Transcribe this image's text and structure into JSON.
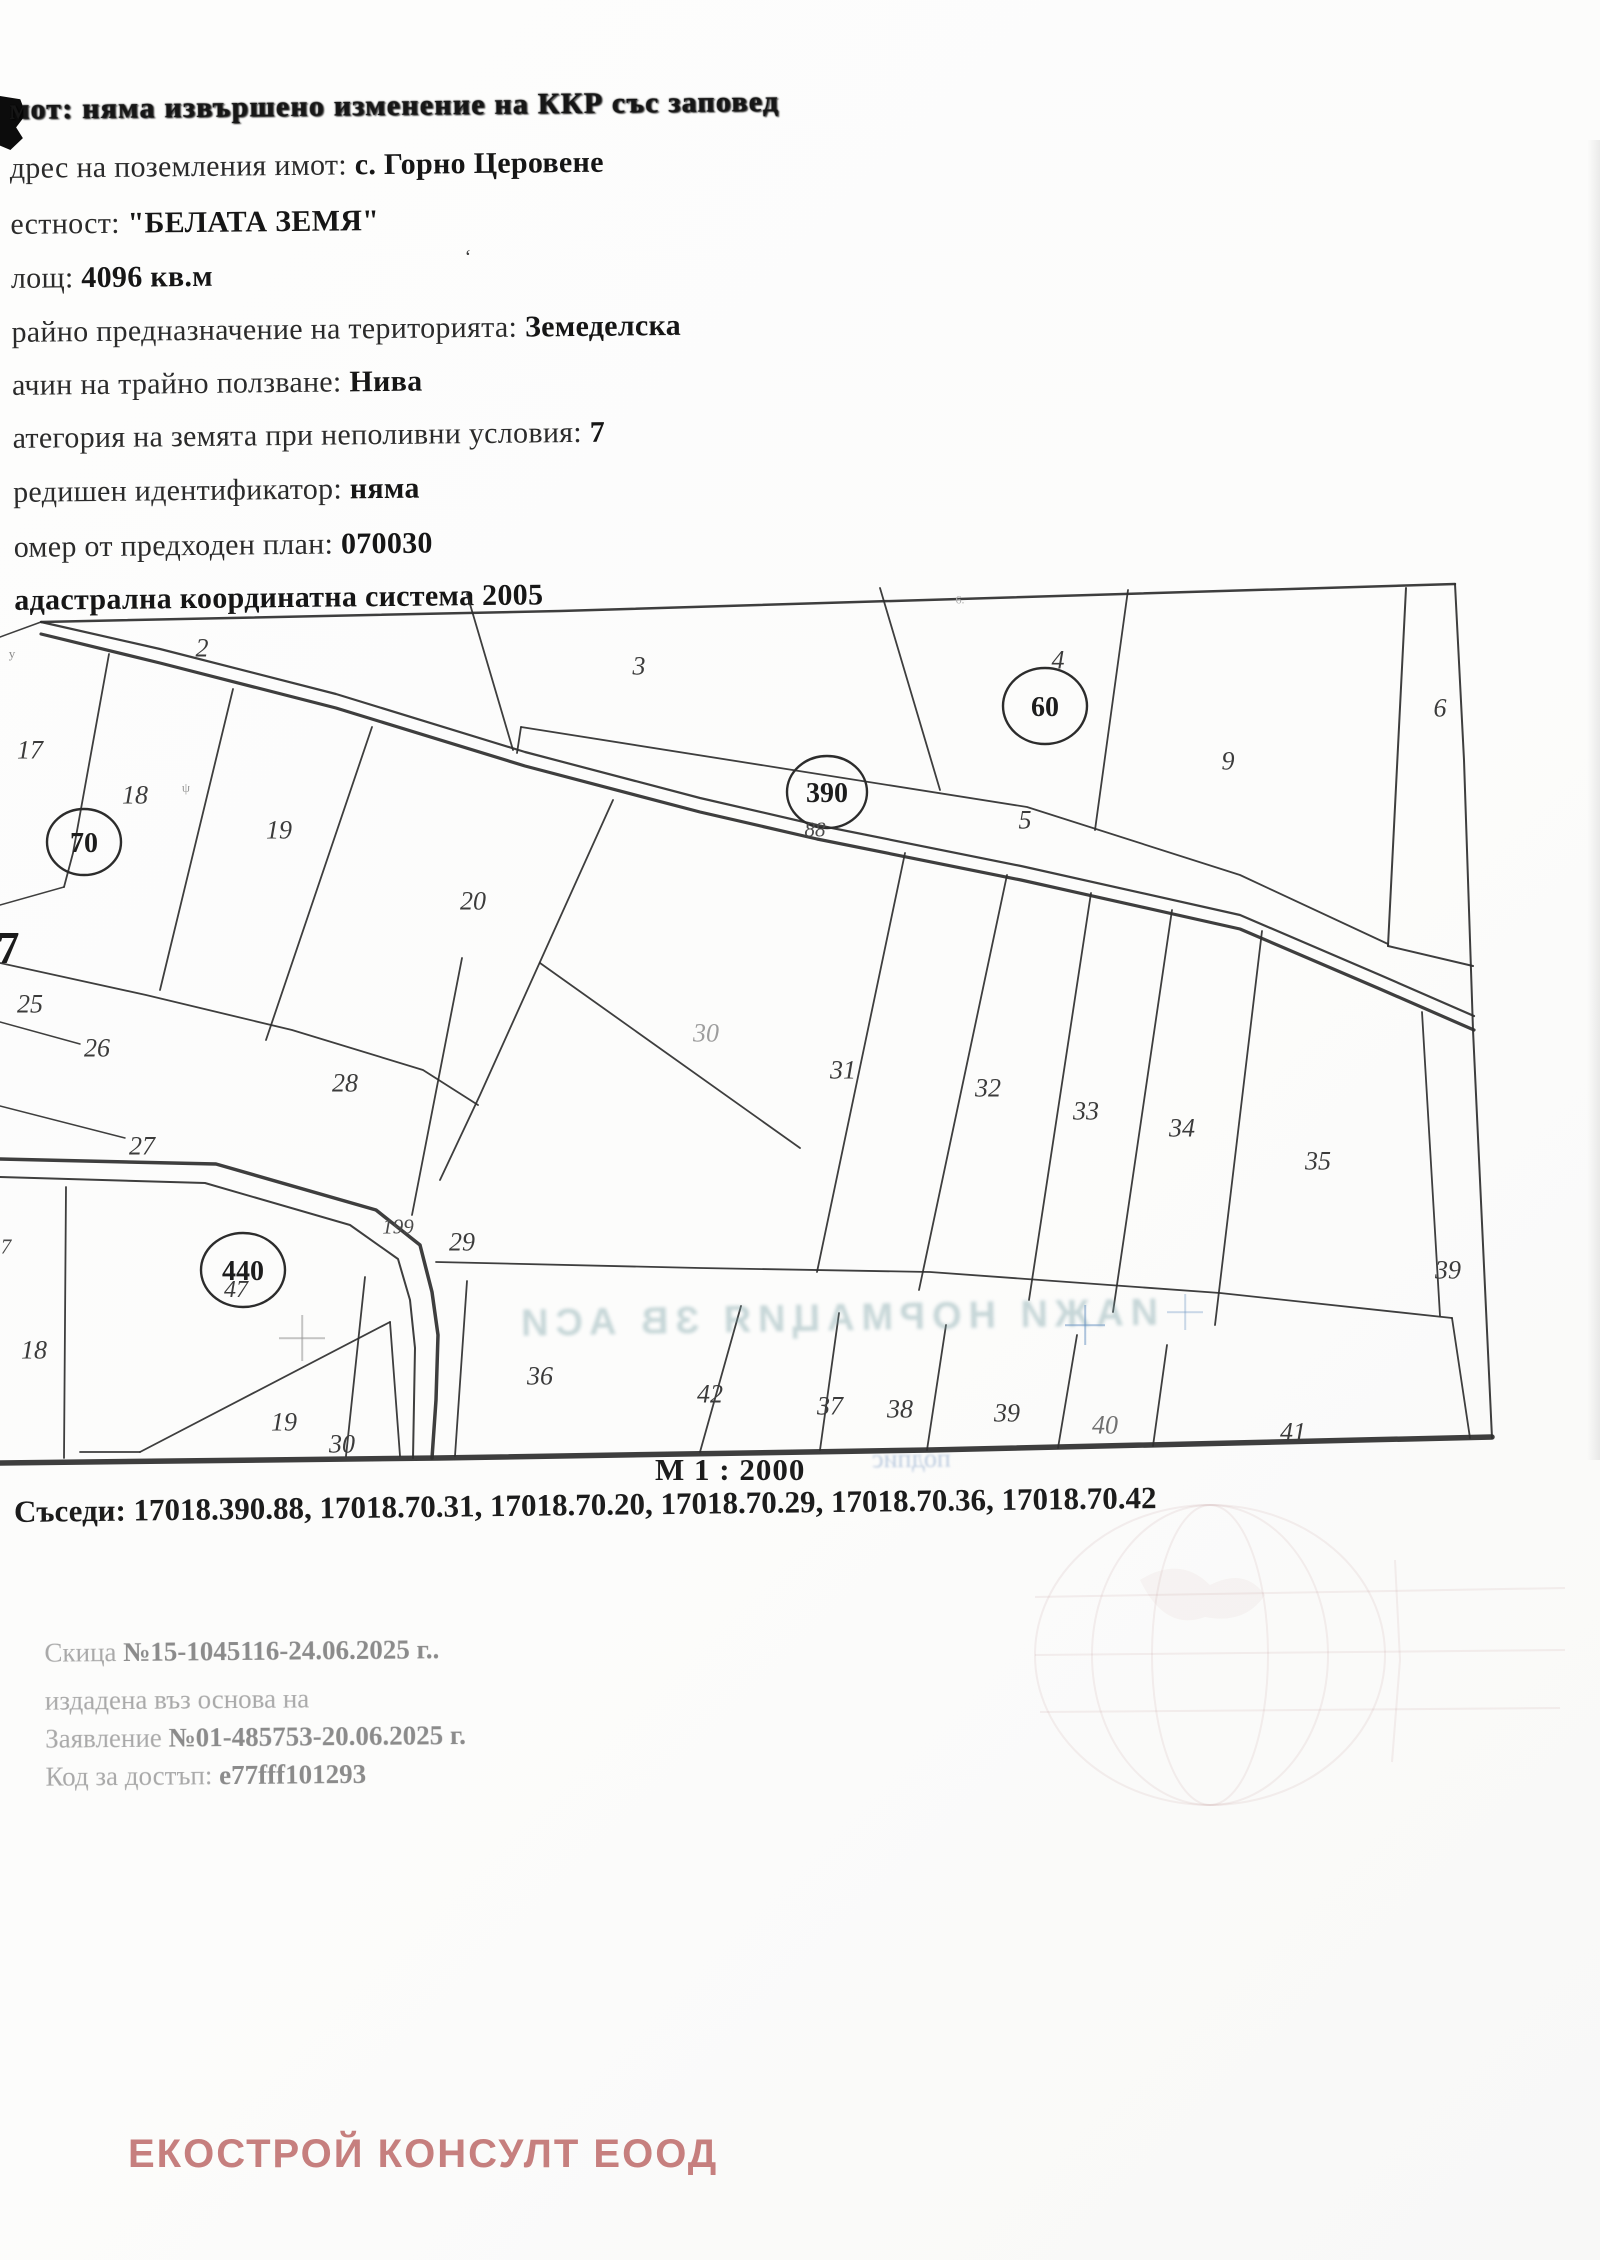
{
  "header": {
    "lines": [
      {
        "base": 123,
        "smeared": true,
        "parts": [
          {
            "t": "мот: ",
            "b": true
          },
          {
            "t": "няма извършено изменение на ККР със заповед",
            "b": true
          }
        ]
      },
      {
        "base": 182,
        "parts": [
          {
            "t": "дрес на поземления имот: "
          },
          {
            "t": "с. Горно Церовене",
            "b": true
          }
        ]
      },
      {
        "base": 238,
        "parts": [
          {
            "t": "естност: "
          },
          {
            "t": "\"БЕЛАТА ЗЕМЯ\"",
            "b": true
          }
        ]
      },
      {
        "base": 292,
        "parts": [
          {
            "t": "лощ: "
          },
          {
            "t": "4096 кв.м",
            "b": true
          }
        ]
      },
      {
        "base": 346,
        "parts": [
          {
            "t": "райно предназначение на територията: "
          },
          {
            "t": "Земеделска",
            "b": true
          }
        ]
      },
      {
        "base": 399,
        "parts": [
          {
            "t": "ачин на трайно ползване: "
          },
          {
            "t": "Нива",
            "b": true
          }
        ]
      },
      {
        "base": 452,
        "parts": [
          {
            "t": "атегория на земята при неполивни условия: "
          },
          {
            "t": "7",
            "b": true
          }
        ]
      },
      {
        "base": 506,
        "parts": [
          {
            "t": "редишен идентификатор: "
          },
          {
            "t": "няма",
            "b": true
          }
        ]
      },
      {
        "base": 561,
        "parts": [
          {
            "t": "омер от предходен план: "
          },
          {
            "t": "070030",
            "b": true
          }
        ]
      },
      {
        "base": 614,
        "parts": [
          {
            "t": "адастрална координатна система 2005",
            "b": true
          }
        ]
      }
    ]
  },
  "map": {
    "scale_label": "М 1 : 2000",
    "neighbors": "Съседи: 17018.390.88, 17018.70.31, 17018.70.20, 17018.70.29, 17018.70.36, 17018.70.42",
    "paths": [
      {
        "d": "M41,622 L560,611 L1455,584",
        "w": 2.5
      },
      {
        "d": "M1455,584 L1464,760 L1473,1030 L1492,1438",
        "w": 2
      },
      {
        "d": "M0,1463 L438,1458 L930,1450 L1492,1437",
        "w": 5.5
      },
      {
        "d": "M1406,588 L1388,946",
        "w": 2
      },
      {
        "d": "M1388,946 L1473,966",
        "w": 2
      },
      {
        "d": "M41,622 L160,649 L336,694 L525,752 L700,798 L817,825 L1021,866 L1240,915 L1380,975 L1474,1016",
        "w": 2.2
      },
      {
        "d": "M41,634 L160,663 L336,708 L525,766 L700,812 L817,839 L1021,880 L1240,929 L1380,989 L1474,1030",
        "w": 3.2
      },
      {
        "d": "M467,594 L513,750",
        "w": 1.8
      },
      {
        "d": "M880,588 L940,790",
        "w": 1.8
      },
      {
        "d": "M1128,590 L1095,830",
        "w": 1.8
      },
      {
        "d": "M521,727 L780,768 L1027,807 L1240,875 L1388,944",
        "w": 1.8
      },
      {
        "d": "M521,727 L517,753",
        "w": 1.8
      },
      {
        "d": "M41,622 L0,637",
        "w": 1.5
      },
      {
        "d": "M109,654 L73,853 L64,887",
        "w": 1.8
      },
      {
        "d": "M233,689 L160,990",
        "w": 1.8
      },
      {
        "d": "M372,727 L266,1040",
        "w": 1.8
      },
      {
        "d": "M0,963 L146,995 L292,1030 L423,1070 L478,1105",
        "w": 1.8
      },
      {
        "d": "M0,905 L64,887",
        "w": 1.5
      },
      {
        "d": "M0,1022 L80,1044",
        "w": 1.5
      },
      {
        "d": "M0,1106 L125,1138",
        "w": 1.5
      },
      {
        "d": "M613,800 L480,1095 L440,1180",
        "w": 1.8
      },
      {
        "d": "M462,958 L412,1215",
        "w": 1.8
      },
      {
        "d": "M540,963 L800,1148",
        "w": 1.8
      },
      {
        "d": "M905,853 L817,1272",
        "w": 1.8
      },
      {
        "d": "M1007,875 L919,1290",
        "w": 1.8
      },
      {
        "d": "M1091,893 L1029,1300",
        "w": 1.8
      },
      {
        "d": "M1172,910 L1113,1312",
        "w": 1.8
      },
      {
        "d": "M1262,931 L1215,1325",
        "w": 1.8
      },
      {
        "d": "M1422,1012 L1440,1316",
        "w": 1.8
      },
      {
        "d": "M436,1262 L700,1268 L930,1272 L1220,1293 L1452,1318",
        "w": 1.8
      },
      {
        "d": "M365,1277 L346,1456",
        "w": 1.8
      },
      {
        "d": "M467,1281 L455,1456",
        "w": 1.8
      },
      {
        "d": "M741,1306 L700,1452",
        "w": 1.8
      },
      {
        "d": "M839,1313 L820,1450",
        "w": 1.8
      },
      {
        "d": "M946,1325 L927,1450",
        "w": 1.8
      },
      {
        "d": "M1077,1335 L1058,1448",
        "w": 1.8
      },
      {
        "d": "M1167,1345 L1153,1446",
        "w": 1.8
      },
      {
        "d": "M1452,1318 L1470,1438",
        "w": 1.8
      },
      {
        "d": "M0,1159 L216,1164 L376,1210 L420,1245 L432,1292 L438,1335 L436,1400 L432,1458",
        "w": 3.5
      },
      {
        "d": "M0,1177 L205,1183 L350,1225 L398,1259 L410,1300 L415,1348 L413,1458",
        "w": 2
      },
      {
        "d": "M66,1187 L64,1458",
        "w": 1.8
      },
      {
        "d": "M80,1452 L140,1452",
        "w": 1.8
      },
      {
        "d": "M140,1452 L390,1322",
        "w": 1.8
      },
      {
        "d": "M390,1322 L400,1456",
        "w": 1.8
      }
    ],
    "circles": [
      {
        "x": 84,
        "y": 842,
        "rx": 37,
        "ry": 33,
        "label": "70"
      },
      {
        "x": 827,
        "y": 792,
        "rx": 40,
        "ry": 36,
        "label": "390"
      },
      {
        "x": 1045,
        "y": 706,
        "rx": 42,
        "ry": 38,
        "label": "60"
      },
      {
        "x": 243,
        "y": 1270,
        "rx": 42,
        "ry": 37,
        "label": "440"
      }
    ],
    "labels": [
      [
        202,
        650,
        "2"
      ],
      [
        639,
        668,
        "3"
      ],
      [
        1058,
        662,
        "4"
      ],
      [
        1440,
        710,
        "6"
      ],
      [
        1228,
        763,
        "9"
      ],
      [
        1025,
        822,
        "5"
      ],
      [
        815,
        831,
        "88",
        "small"
      ],
      [
        30,
        752,
        "17"
      ],
      [
        135,
        797,
        "18"
      ],
      [
        279,
        832,
        "19"
      ],
      [
        473,
        903,
        "20"
      ],
      [
        8,
        950,
        "7",
        "big"
      ],
      [
        30,
        1006,
        "25"
      ],
      [
        97,
        1050,
        "26"
      ],
      [
        142,
        1148,
        "27"
      ],
      [
        345,
        1085,
        "28"
      ],
      [
        706,
        1035,
        "30",
        "faded"
      ],
      [
        843,
        1072,
        "31"
      ],
      [
        988,
        1090,
        "32"
      ],
      [
        1086,
        1113,
        "33"
      ],
      [
        1182,
        1130,
        "34"
      ],
      [
        1318,
        1163,
        "35"
      ],
      [
        1448,
        1272,
        "39"
      ],
      [
        398,
        1228,
        "199",
        "small"
      ],
      [
        462,
        1244,
        "29"
      ],
      [
        236,
        1292,
        "47",
        "mid"
      ],
      [
        6,
        1248,
        "7",
        "small"
      ],
      [
        34,
        1352,
        "18"
      ],
      [
        284,
        1424,
        "19"
      ],
      [
        342,
        1446,
        "30"
      ],
      [
        540,
        1378,
        "36"
      ],
      [
        710,
        1396,
        "42"
      ],
      [
        830,
        1408,
        "37"
      ],
      [
        900,
        1411,
        "38"
      ],
      [
        1007,
        1415,
        "39"
      ],
      [
        1105,
        1427,
        "40",
        "faded2"
      ],
      [
        1293,
        1434,
        "41"
      ]
    ]
  },
  "issue": {
    "lines": [
      {
        "top": 1638,
        "parts": [
          {
            "t": "Скица "
          },
          {
            "t": "№15-1045116-24.06.2025 г..",
            "b": true
          }
        ]
      },
      {
        "top": 1686,
        "parts": [
          {
            "t": "издадена въз основа на"
          }
        ]
      },
      {
        "top": 1724,
        "parts": [
          {
            "t": "Заявление "
          },
          {
            "t": "№01-485753-20.06.2025 г.",
            "b": true
          }
        ]
      },
      {
        "top": 1762,
        "parts": [
          {
            "t": "Код за достъп: "
          },
          {
            "t": "e77fff101293",
            "b": true
          }
        ]
      }
    ]
  },
  "watermark": {
    "text": "ЕКОСТРОЙ КОНСУЛТ ЕООД",
    "color": "#c67f7e"
  },
  "artifacts": {
    "bleed_text_large": "ИАЖИ НОРМАЦИЯ ЗВ АСИ",
    "bleed_text_small": "подпис",
    "crosses": [
      {
        "x": 302,
        "y": 1338,
        "size": 46,
        "color": "rgba(150,150,150,0.55)"
      },
      {
        "x": 1085,
        "y": 1325,
        "size": 40,
        "color": "rgba(110,150,195,0.55)"
      },
      {
        "x": 1185,
        "y": 1312,
        "size": 36,
        "color": "rgba(110,150,195,0.35)"
      }
    ],
    "tiny_marks": [
      {
        "x": 468,
        "y": 258,
        "t": "ʻ",
        "c": "#3d3d3d",
        "s": 20
      },
      {
        "x": 186,
        "y": 788,
        "t": "ψ",
        "c": "#9a9a9a",
        "s": 13
      },
      {
        "x": 960,
        "y": 600,
        "t": "6.",
        "c": "#ababab",
        "s": 12
      },
      {
        "x": 12,
        "y": 654,
        "t": "y",
        "c": "#8a8a8a",
        "s": 13
      }
    ]
  }
}
